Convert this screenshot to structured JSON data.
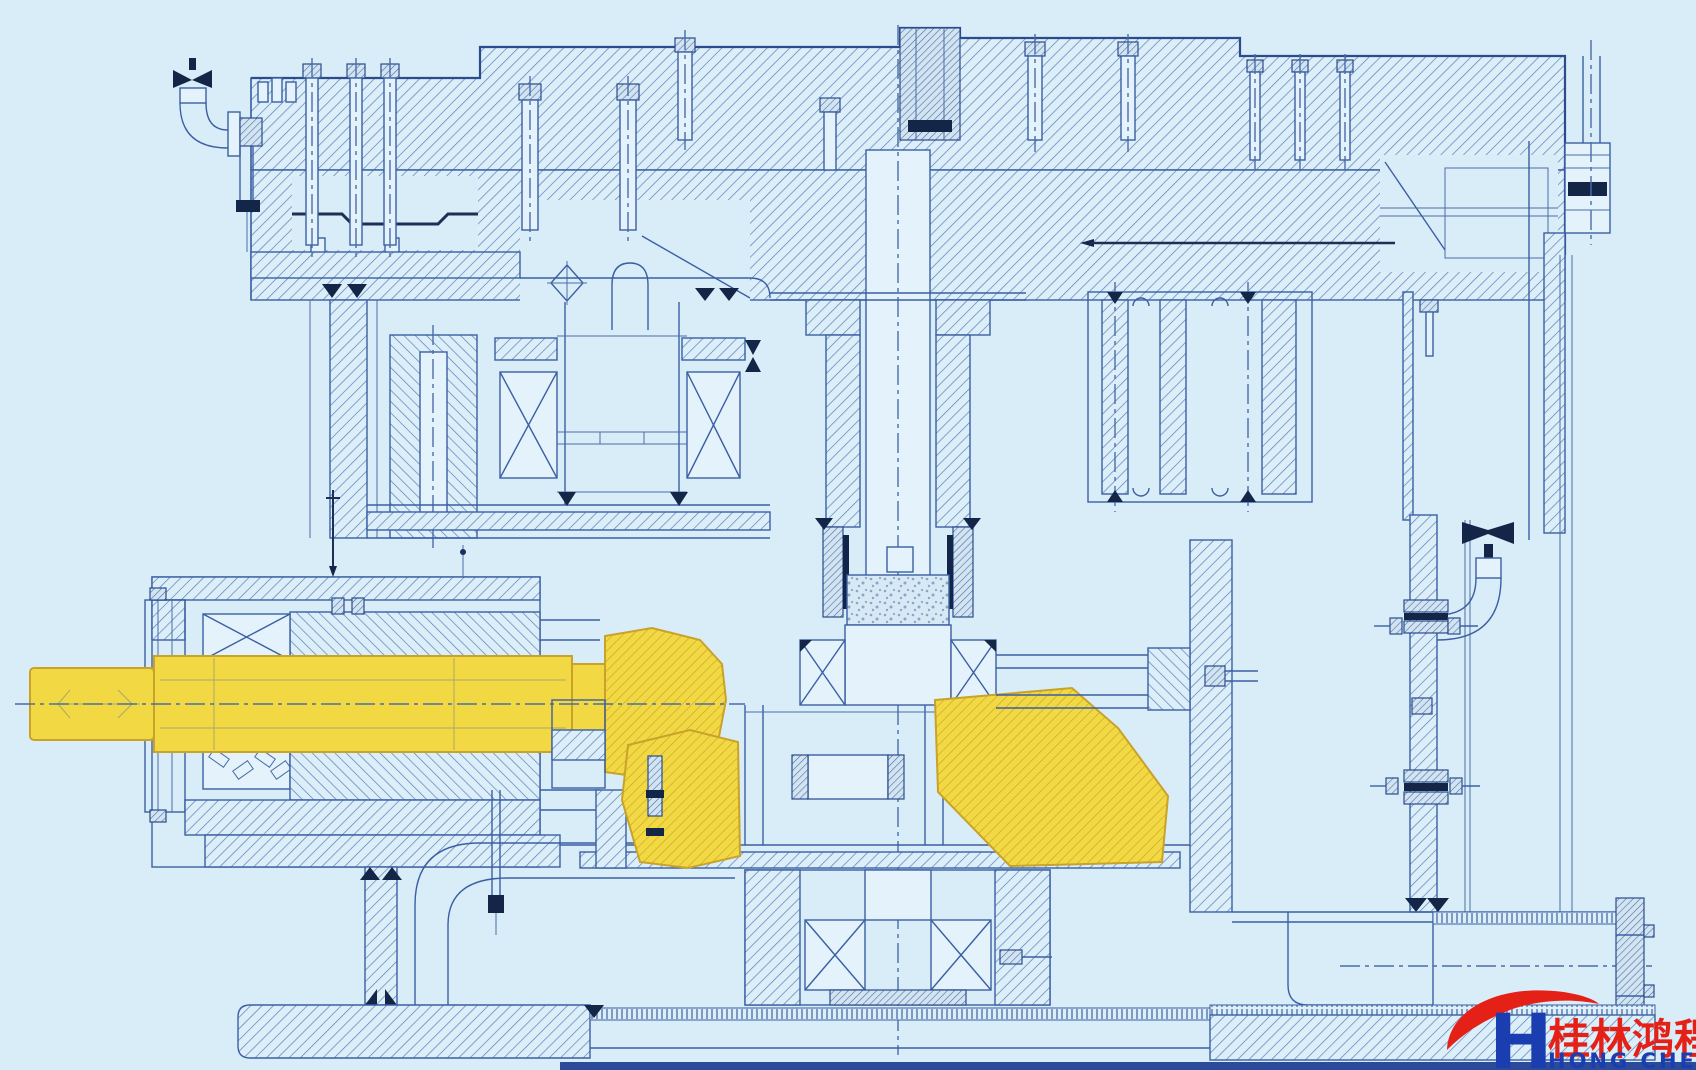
{
  "canvas": {
    "background": "#d9edf8",
    "bottom_border_color": "#2b4a99"
  },
  "drawing": {
    "type": "engineering-cross-section",
    "subject": "vertical-mill-gearbox-sectional-blueprint",
    "line_color": "#3b5fa3",
    "hatch_color": "#5b7fbc",
    "dark_color": "#132647",
    "highlight": {
      "fill": "#f2d944",
      "stroke": "#c9a22a",
      "parts": [
        "input-shaft",
        "bevel-pinion",
        "bevel-ring-gear"
      ]
    }
  },
  "logo": {
    "h": "H",
    "chinese": "桂林鸿程",
    "english": "HONG CHENG",
    "red": "#e42017",
    "blue": "#1a3eb0"
  }
}
